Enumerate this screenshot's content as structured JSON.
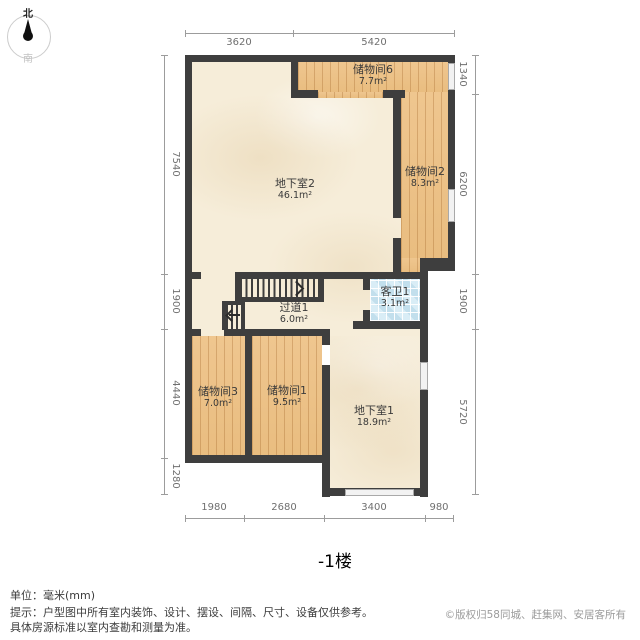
{
  "compass": {
    "north": "北",
    "south": "南"
  },
  "floor_title": "-1楼",
  "rooms": [
    {
      "name": "地下室2",
      "area": "46.1m²"
    },
    {
      "name": "储物间6",
      "area": "7.7m²"
    },
    {
      "name": "储物间2",
      "area": "8.3m²"
    },
    {
      "name": "过道1",
      "area": "6.0m²"
    },
    {
      "name": "客卫1",
      "area": "3.1m²"
    },
    {
      "name": "储物间3",
      "area": "7.0m²"
    },
    {
      "name": "储物间1",
      "area": "9.5m²"
    },
    {
      "name": "地下室1",
      "area": "18.9m²"
    }
  ],
  "dimensions": {
    "top": [
      "3620",
      "5420"
    ],
    "bottom": [
      "1980",
      "2680",
      "3400",
      "980"
    ],
    "left": [
      "7540",
      "1900",
      "4440",
      "1280"
    ],
    "right": [
      "1340",
      "6200",
      "1900",
      "5720"
    ]
  },
  "footer": {
    "unit": "单位：毫米(mm)",
    "tip_line1": "提示：户型图中所有室内装饰、设计、摆设、间隔、尺寸、设备仅供参考。",
    "tip_line2": "具体房源标准以室内查勘和测量为准。",
    "copyright": "©版权归58同城、赶集网、安居客所有"
  },
  "colors": {
    "wall": "#3e3e3e",
    "wood_floor": "#ecc389",
    "marble_floor": "#f6edd9",
    "bath_tile": "#d9edf6",
    "window": "#f2f2f2",
    "dimension_text": "#6f6f6f"
  }
}
